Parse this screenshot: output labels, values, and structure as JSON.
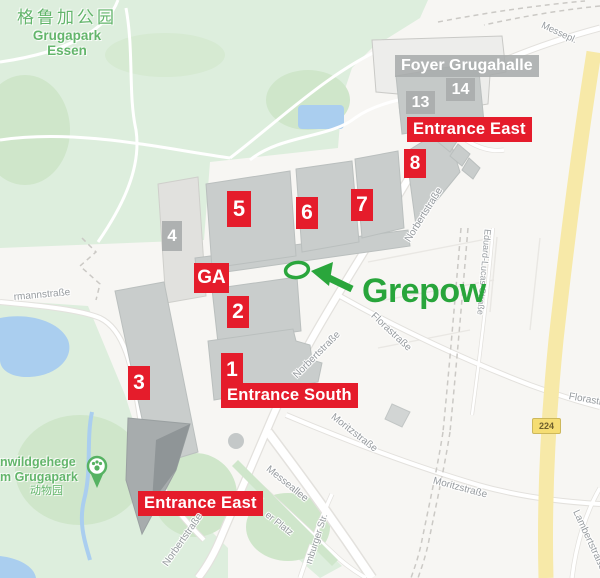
{
  "colors": {
    "badge_red": "#e51c2b",
    "badge_gray": "#a8acac",
    "park_green": "#ddeedd",
    "tree_green": "#cfe6ca",
    "building_gray": "#c9cdcc",
    "building_dark": "#8f9597",
    "water_blue": "#aaceef",
    "road_yellow": "#f7e9a8",
    "brand_green": "#28a53b",
    "street_label": "#969b9f"
  },
  "park": {
    "title_cn": "格鲁加公园",
    "title_en1": "Grugapark",
    "title_en2": "Essen",
    "zoo_l1": "nwildgehege",
    "zoo_l2": "m Grugapark",
    "zoo_cn": "动物园"
  },
  "halls": {
    "h1": "1",
    "h2": "2",
    "h3": "3",
    "h4": "4",
    "h5": "5",
    "h6": "6",
    "h7": "7",
    "h8": "8",
    "h13": "13",
    "h14": "14",
    "ga": "GA",
    "foyer": "Foyer Grugahalle"
  },
  "entrances": {
    "east_top": "Entrance East",
    "south": "Entrance South",
    "east_bottom": "Entrance East"
  },
  "streets": {
    "messeplatz": "Messepl.",
    "norbert": "Norbertstraße",
    "flora": "Florastraße",
    "eduard": "Eduard-Lucas-Straße",
    "moritz": "Moritzstraße",
    "messeallee": "Messeallee",
    "luhrmann_fragment": "rmannstraße",
    "platz_fragment": "er Platz",
    "burger_fragment": "mburger Str.",
    "lambert": "Lambertstraße"
  },
  "route_badge": "224",
  "annotation": {
    "label": "Grepow"
  }
}
